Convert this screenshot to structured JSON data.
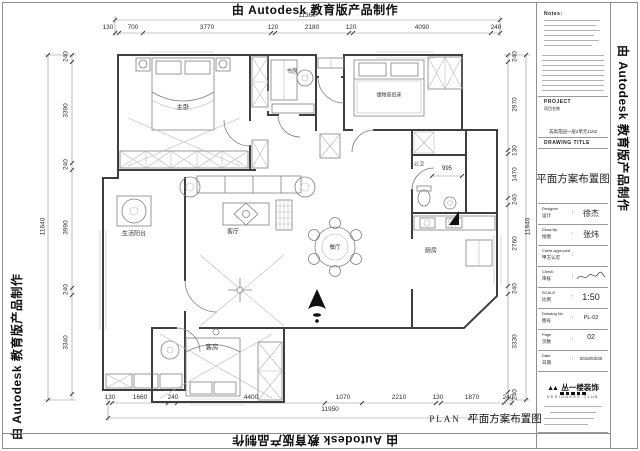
{
  "watermark": {
    "text": "由 Autodesk 教育版产品制作"
  },
  "plan": {
    "rooms": [
      {
        "label": "主卧"
      },
      {
        "label": "书房"
      },
      {
        "label": "储物高低床"
      },
      {
        "label": "公卫"
      },
      {
        "label": "厨房"
      },
      {
        "label": "餐厅"
      },
      {
        "label": "客厅"
      },
      {
        "label": "生活阳台"
      },
      {
        "label": "客房"
      }
    ],
    "bath_dim": "995",
    "caption_en": "PLAN",
    "caption_cn": "平面方案布置图"
  },
  "dims": {
    "top": {
      "overall": "11360",
      "segments": [
        "130",
        "700",
        "3770",
        "120",
        "2180",
        "120",
        "4090",
        "240"
      ]
    },
    "bottom": {
      "overall": "11950",
      "segments": [
        "130",
        "1660",
        "240",
        "4400",
        "1070",
        "2210",
        "130",
        "1870",
        "240"
      ]
    },
    "left": {
      "overall": "11640",
      "segments": [
        "240",
        "3390",
        "240",
        "3990",
        "240",
        "3340"
      ]
    },
    "right": {
      "overall": "11640",
      "segments": [
        "240",
        "2970",
        "130",
        "1470",
        "240",
        "2760",
        "240",
        "3330",
        "240"
      ]
    }
  },
  "titleblock": {
    "notes_title": "Notes:",
    "project_en": "PROJECT",
    "project_cn": "项目名称",
    "project_name": "志高花园一层2单元1102",
    "drawing_title_en": "DRAWING TITLE",
    "drawing_title": "平面方案布置图",
    "colon": ":",
    "rows": [
      {
        "en": "Designer",
        "cn": "设计",
        "value": "徐杰"
      },
      {
        "en": "Draw By",
        "cn": "绘图",
        "value": "张炜"
      },
      {
        "en": "Client approved",
        "cn": "甲方认可",
        "value": ""
      },
      {
        "en": "Check",
        "cn": "审核",
        "value": ""
      },
      {
        "en": "SCALE",
        "cn": "比例",
        "value": "1:50"
      },
      {
        "en": "Drawing No",
        "cn": "图号",
        "value": "PL-02"
      },
      {
        "en": "Page",
        "cn": "页数",
        "value": "02"
      },
      {
        "en": "Date",
        "cn": "日期",
        "value": "2018/03/30"
      }
    ],
    "logo_text": "丛一楼装饰",
    "logo_sub": "DESIGNERS CLUB"
  },
  "colors": {
    "ink": "#1a1a1a"
  }
}
